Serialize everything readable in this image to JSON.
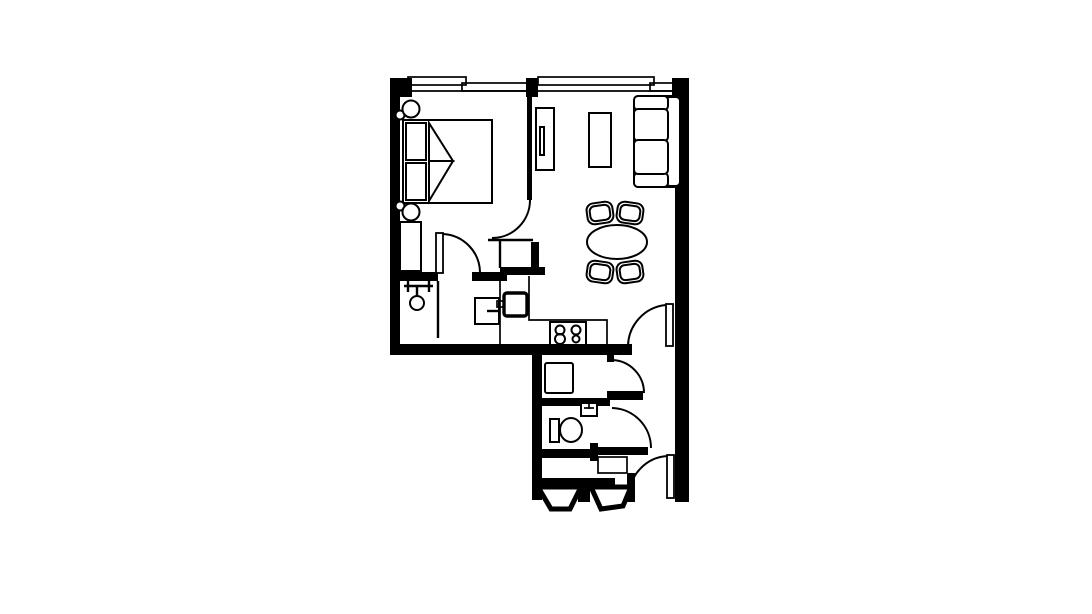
{
  "page": {
    "background": "#ffffff",
    "drawing": "apartment-floor-plan"
  },
  "palette": {
    "wall_color": "#000000",
    "line_color": "#000000",
    "floor_color": "#ffffff"
  },
  "plan": {
    "type": "one-bedroom-apartment-floor-plan",
    "counts": {
      "windows": 2,
      "door_swings": 6
    },
    "rooms": [
      {
        "name": "bedroom",
        "position": "top-left",
        "items": [
          "double-bed",
          "pillows",
          "blanket-folds",
          "bedside-lamp-top",
          "bedside-lamp-bottom",
          "dresser",
          "closet-with-hanging-rail"
        ]
      },
      {
        "name": "living-dining-room",
        "position": "top-right",
        "items": [
          "sofa",
          "tv-console",
          "media-cabinet",
          "oval-dining-table",
          "dining-chairs-x4"
        ]
      },
      {
        "name": "kitchen",
        "position": "center",
        "items": [
          "counter-l-shape",
          "sink",
          "cooktop-four-burners",
          "small-cabinet"
        ]
      },
      {
        "name": "laundry-room",
        "position": "lower-center",
        "items": [
          "washing-machine"
        ]
      },
      {
        "name": "bathroom",
        "position": "lower-center",
        "items": [
          "toilet",
          "washbasin"
        ]
      },
      {
        "name": "entry-hall",
        "position": "lower-right",
        "items": [
          "entry-door",
          "closet-niche",
          "angled-vestibule-walls"
        ]
      }
    ],
    "windows": [
      {
        "name": "bedroom-window",
        "wall": "top"
      },
      {
        "name": "living-room-window",
        "wall": "top"
      }
    ]
  }
}
